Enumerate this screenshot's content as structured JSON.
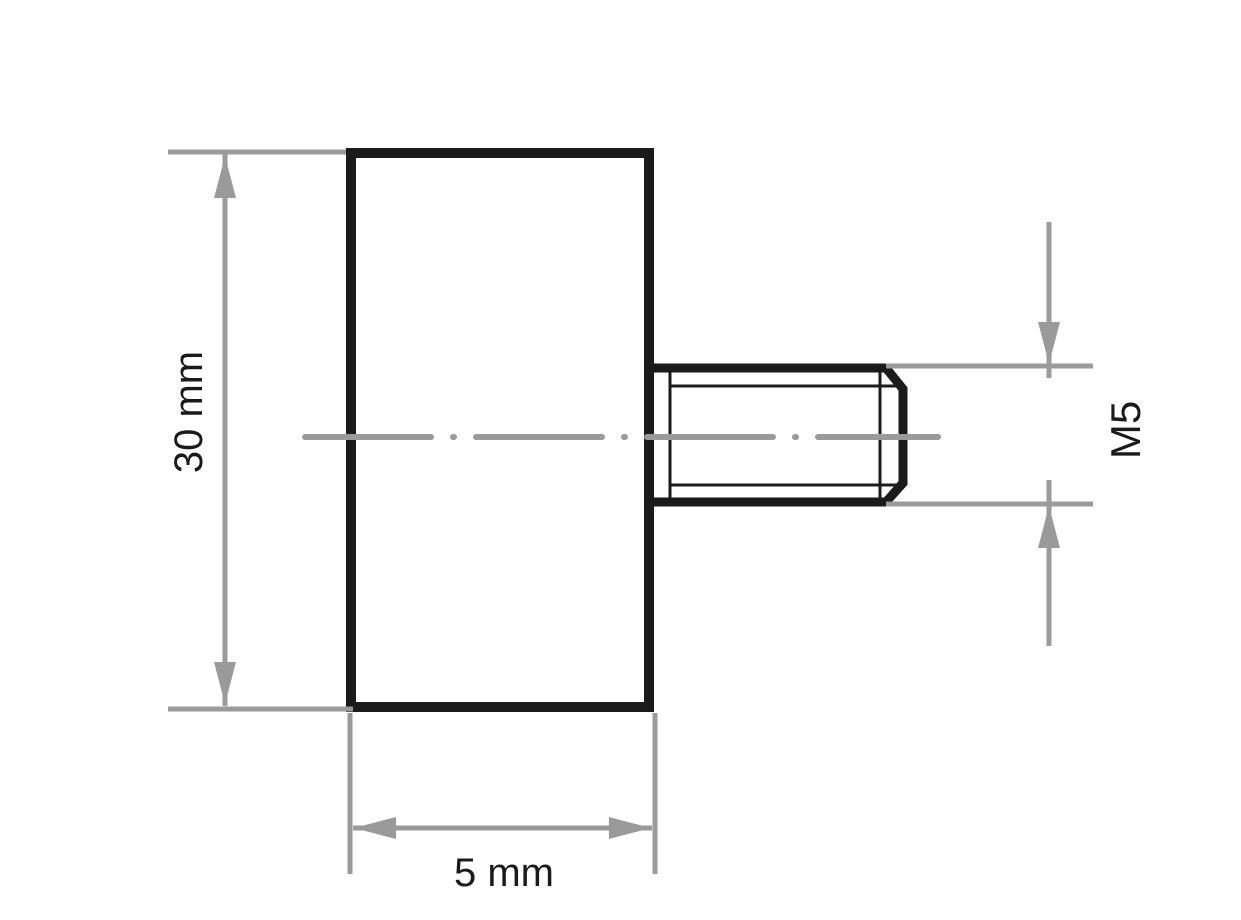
{
  "labels": {
    "height": "30 mm",
    "width": "5 mm",
    "thread": "M5"
  },
  "colors": {
    "outline": "#1b1b1b",
    "dimension": "#9a9a9a",
    "text": "#1a1a1a",
    "background": "#ffffff"
  }
}
